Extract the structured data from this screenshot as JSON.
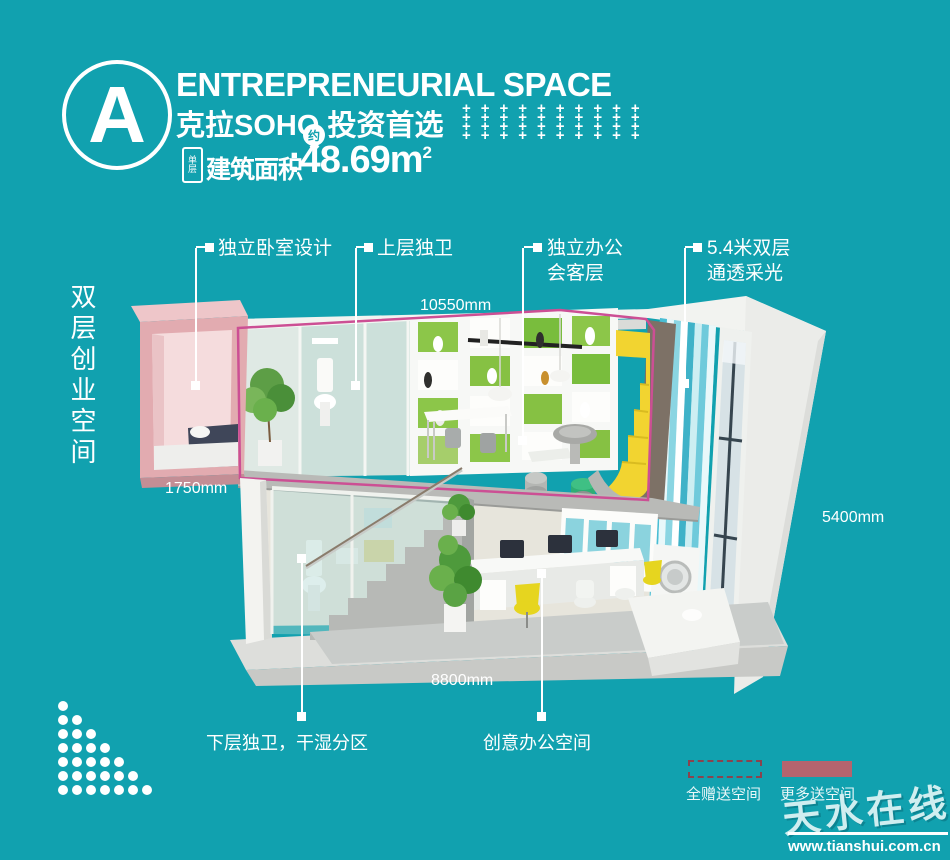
{
  "colors": {
    "background": "#11a1af",
    "accent_magenta": "#cc4f94",
    "legend_dash": "#8a434e",
    "legend_solid": "#b5646e"
  },
  "header": {
    "badge_letter": "A",
    "title_en": "ENTREPRENEURIAL SPACE",
    "title_cn": "克拉SOHO 投资首选",
    "plus_pattern": {
      "rows": 4,
      "cols": 10,
      "glyph": "+"
    },
    "area_tag": "单层",
    "area_label": "建筑面积",
    "area_approx": "约",
    "area_colon": ":",
    "area_value": "48.69m",
    "area_sup": "2"
  },
  "side_label": "双层创业空间",
  "callouts": {
    "bedroom": "独立卧室设计",
    "upper_bath": "上层独卫",
    "office_line1": "独立办公",
    "office_line2": "会客层",
    "daylight_line1": "5.4米双层",
    "daylight_line2": "通透采光",
    "lower_bath": "下层独卫，干湿分区",
    "creative_office": "创意办公空间"
  },
  "dimensions": {
    "width_top": "10550mm",
    "bedroom_width": "1750mm",
    "height_right": "5400mm",
    "width_bottom": "8800mm"
  },
  "legend": {
    "gift_all": "全赠送空间",
    "gift_more": "更多送空间"
  },
  "watermark": {
    "brand": "天水在线",
    "url": "www.tianshui.com.cn"
  },
  "decor": {
    "dot_rows": 7
  }
}
